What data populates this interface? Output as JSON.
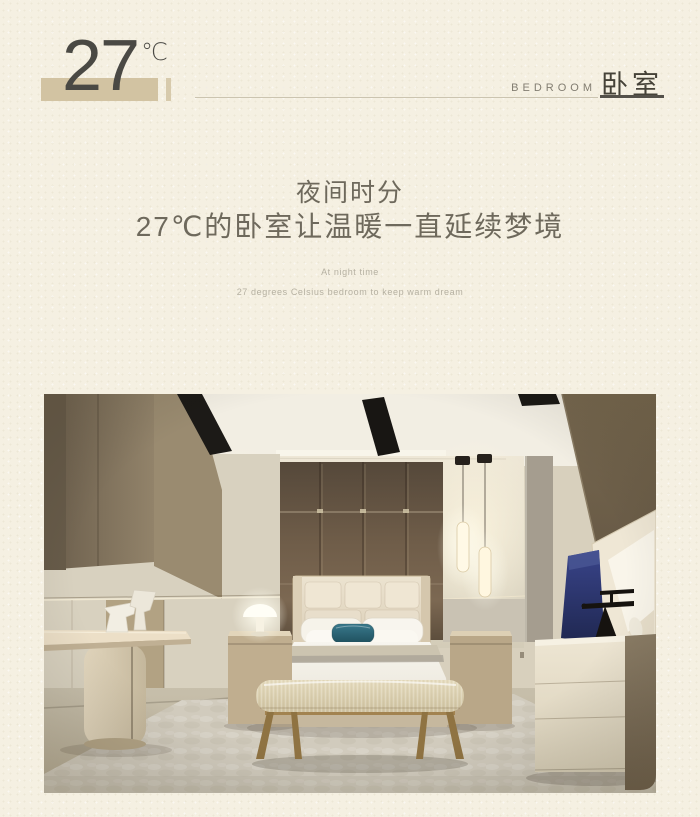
{
  "page": {
    "bg_color": "#f5f0e2"
  },
  "header": {
    "temperature_value": "27",
    "temperature_unit": "℃",
    "category_en": "BEDROOM",
    "category_zh": "卧室",
    "accent_color": "#d2c3a2"
  },
  "intro": {
    "heading_line1": "夜间时分",
    "heading_line2": "27℃的卧室让温暖一直延续梦境",
    "subheading_line1": "At night time",
    "subheading_line2": "27 degrees Celsius bedroom to keep warm dream"
  },
  "photo": {
    "palette": {
      "wall_brown": "#6f5d49",
      "wall_beige": "#ddd5c3",
      "teal_pillow": "#2e7385",
      "navy_art": "#2c3568",
      "bench_gold": "#9b7c46",
      "rug_gray": "#d1cbbd"
    }
  }
}
